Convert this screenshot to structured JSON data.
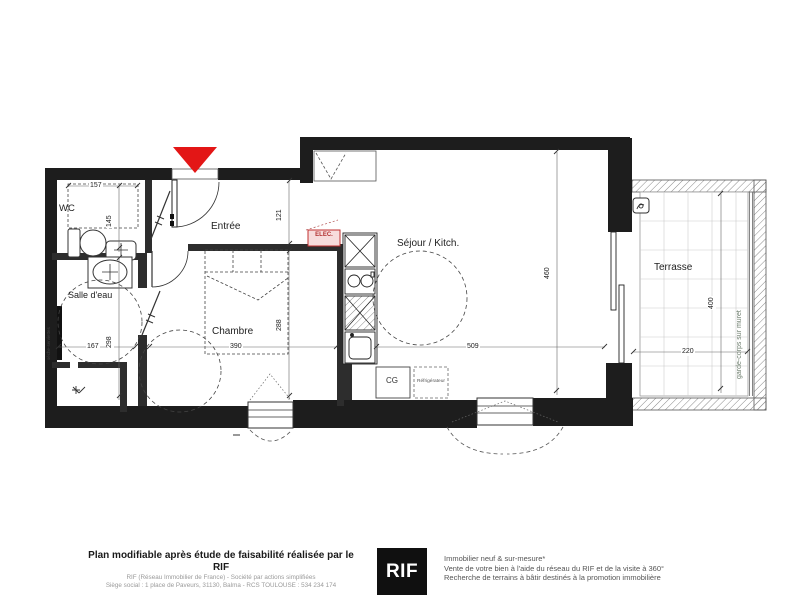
{
  "plan": {
    "rooms": {
      "wc": "WC",
      "entree": "Entrée",
      "salle_deau": "Salle d'eau",
      "chambre": "Chambre",
      "sejour": "Séjour / Kitch.",
      "terrasse": "Terrasse"
    },
    "labels": {
      "elec": "ELEC.",
      "cg": "CG",
      "refrigerateur": "Réfrigérateur",
      "seche_serviettes": "sèche-serviettes",
      "garde_corps": "garde-corps sur muret"
    },
    "dims": {
      "wc_w": "157",
      "wc_d": "145",
      "entree_d": "121",
      "sde_w": "167",
      "sde_d": "298",
      "chambre_w": "390",
      "chambre_d": "288",
      "sejour_w": "509",
      "sejour_d": "460",
      "terrasse_d": "400",
      "terrasse_w": "220"
    },
    "colors": {
      "wall": "#1d1d1d",
      "entrance_marker": "#e31616",
      "elec_red": "#b23030"
    }
  },
  "footer": {
    "left": {
      "title": "Plan modifiable après étude de faisabilité réalisée par le RIF",
      "line1": "RIF (Réseau Immobilier de France) - Société par actions simplifiées",
      "line2": "Siège social : 1 place de Paveurs, 31130, Balma - RCS TOULOUSE : 534 234 174"
    },
    "logo_text": "RIF",
    "right": {
      "line1": "Immobilier neuf & sur-mesure*",
      "line2": "Vente de votre bien à l'aide du réseau du RIF et de la visite à 360°",
      "line3": "Recherche de terrains à bâtir destinés à la promotion immobilière"
    }
  }
}
